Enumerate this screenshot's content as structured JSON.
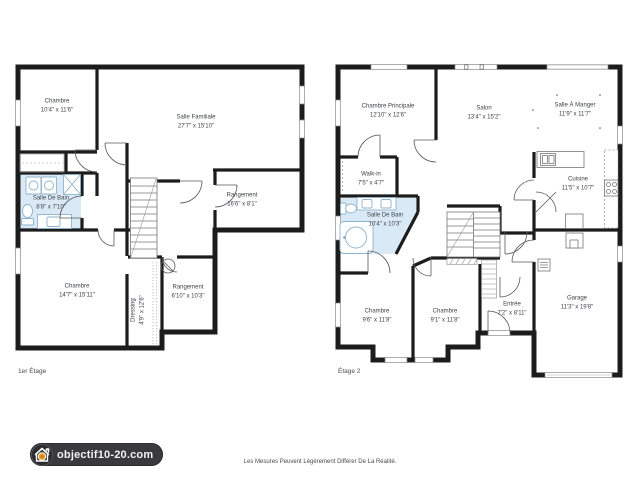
{
  "plans": [
    {
      "name": "1er Étage",
      "rooms": [
        {
          "label": "Chambre",
          "dims": "10'4\" x 11'6\""
        },
        {
          "label": "Salle Familiale",
          "dims": "27'7\" x 15'10\""
        },
        {
          "label": "Salle De Bain",
          "dims": "8'8\" x 7'10\""
        },
        {
          "label": "Rangement",
          "dims": "16'6\" x 8'1\""
        },
        {
          "label": "Chambre",
          "dims": "14'7\" x 15'11\""
        },
        {
          "label": "Dressing",
          "dims": "4'9\" x 12'6\""
        },
        {
          "label": "Rangement",
          "dims": "6'10\" x 10'3\""
        }
      ]
    },
    {
      "name": "Étage 2",
      "rooms": [
        {
          "label": "Chambre Principale",
          "dims": "12'10\" x 12'6\""
        },
        {
          "label": "Salon",
          "dims": "13'4\" x 15'2\""
        },
        {
          "label": "Salle À Manger",
          "dims": "11'9\" x 11'7\""
        },
        {
          "label": "Walk-in",
          "dims": "7'5\" x 4'7\""
        },
        {
          "label": "Salle De Bain",
          "dims": "10'4\" x 10'3\""
        },
        {
          "label": "Cuisine",
          "dims": "11'5\" x 10'7\""
        },
        {
          "label": "Chambre",
          "dims": "9'6\" x 11'8\""
        },
        {
          "label": "Chambre",
          "dims": "9'1\" x 11'8\""
        },
        {
          "label": "Entrée",
          "dims": "7'2\" x 8'11\""
        },
        {
          "label": "Garage",
          "dims": "11'3\" x 19'8\""
        }
      ]
    }
  ],
  "footer": {
    "logo_text": "objectif10-20.com",
    "disclaimer": "Les Mesures Peuvent Légèrement Différer De La Réalité."
  },
  "colors": {
    "wall": "#1c1c1c",
    "bath_fill": "#d9eaf6",
    "logo_bg": "#3a3a3c",
    "logo_accent": "#f0a22e"
  }
}
